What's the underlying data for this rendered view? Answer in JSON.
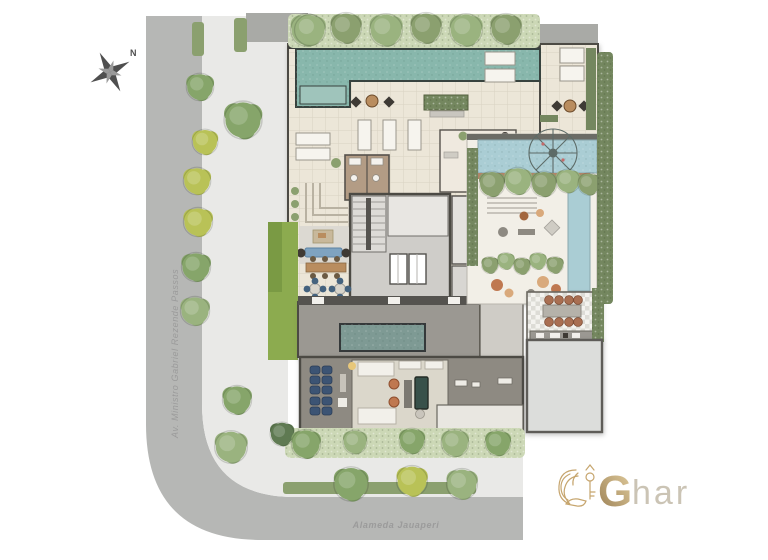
{
  "compass": {
    "north_label": "N"
  },
  "streets": {
    "left_name": "Av. Ministro Gabriel Rezende Passos",
    "bottom_name": "Alameda Jauaperi"
  },
  "logo": {
    "initial": "G",
    "rest": "har"
  },
  "colors": {
    "street": "#b6b7b5",
    "sidewalk": "#e9e9e7",
    "asphalt_pad": "#a9aaa6",
    "building_beige": "#ece6d8",
    "deck_light": "#f2efe7",
    "wall_dark": "#4c4a44",
    "pool_teal": "#88b7ac",
    "pool_blue": "#aacdd4",
    "pool_indoor": "#7e9a94",
    "lawn_green": "#8cab4f",
    "hedge_dark": "#74875f",
    "hedge_mid": "#8ba06f",
    "hedge_band": "#ccd8b6",
    "tree_green": "#86a56a",
    "tree_green2": "#9ab37f",
    "tree_yellow": "#b9c257",
    "tree_dark": "#5f7a52",
    "floor_dark": "#8e8a82",
    "floor_gray": "#9b9892",
    "room_light": "#dbd7cb",
    "room_gray": "#dcdddb",
    "core_gray": "#cfcdc9",
    "seat_navy": "#3c5474",
    "sofa_blue": "#7fa3c0",
    "accent_orange": "#bf7850",
    "accent_tan": "#d9a97b",
    "wood_brown": "#b98d5f",
    "chair_brown": "#a96f52",
    "billiard_green": "#38514a",
    "logo_gold": "#c09c5f",
    "logo_gold_dark": "#8d6f3f",
    "logo_gold_light": "#e2cb97",
    "logo_har_gray": "#c6beae",
    "label_gray": "#9b9b9b"
  }
}
